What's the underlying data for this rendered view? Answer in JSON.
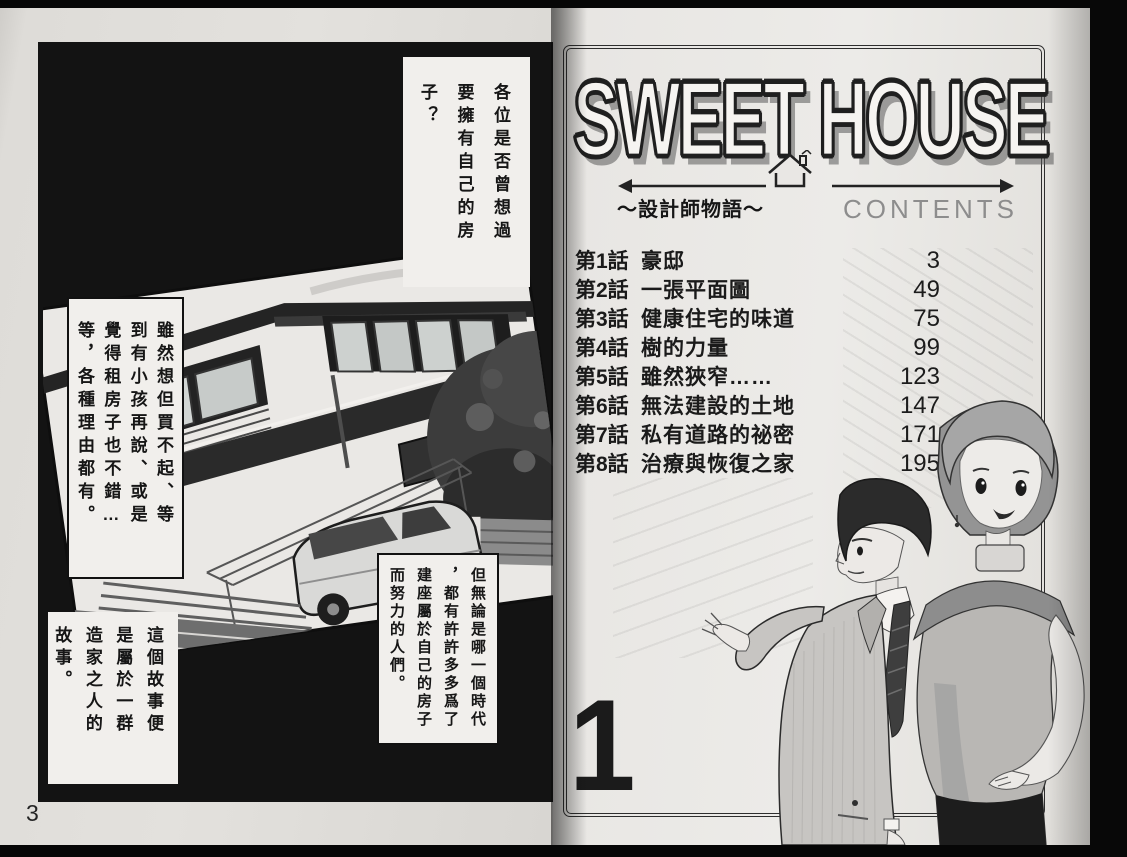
{
  "colors": {
    "paper": "#e8e6e3",
    "ink": "#1a1a1a",
    "panel_black": "#131313",
    "contents_gray": "#8d8d8d"
  },
  "icons": {
    "logo_house": "house-arrow-icon"
  },
  "left_page": {
    "page_number": "3",
    "narration_boxes": [
      {
        "text": "各位是否曾想過\n要擁有自己的房\n子？"
      },
      {
        "text": "雖然想但買不起、等\n到有小孩再說、或是\n覺得租房子也不錯…\n等，各種理由都有。"
      },
      {
        "text": "但無論是哪一個時代\n，都有許許多多爲了\n建座屬於自己的房子\n而努力的人們。"
      },
      {
        "text": "這個故事便\n是屬於一群\n造家之人的\n故事。"
      }
    ]
  },
  "right_page": {
    "logo_title": "SWEET HOUSE",
    "subtitle": "～設計師物語～",
    "contents_heading": "CONTENTS",
    "volume_number": "1",
    "chapters": [
      {
        "label": "第1話",
        "title": "豪邸",
        "page": "3"
      },
      {
        "label": "第2話",
        "title": "一張平面圖",
        "page": "49"
      },
      {
        "label": "第3話",
        "title": "健康住宅的味道",
        "page": "75"
      },
      {
        "label": "第4話",
        "title": "樹的力量",
        "page": "99"
      },
      {
        "label": "第5話",
        "title": "雖然狹窄……",
        "page": "123"
      },
      {
        "label": "第6話",
        "title": "無法建設的土地",
        "page": "147"
      },
      {
        "label": "第7話",
        "title": "私有道路的祕密",
        "page": "171"
      },
      {
        "label": "第8話",
        "title": "治療與恢復之家",
        "page": "195"
      }
    ]
  }
}
